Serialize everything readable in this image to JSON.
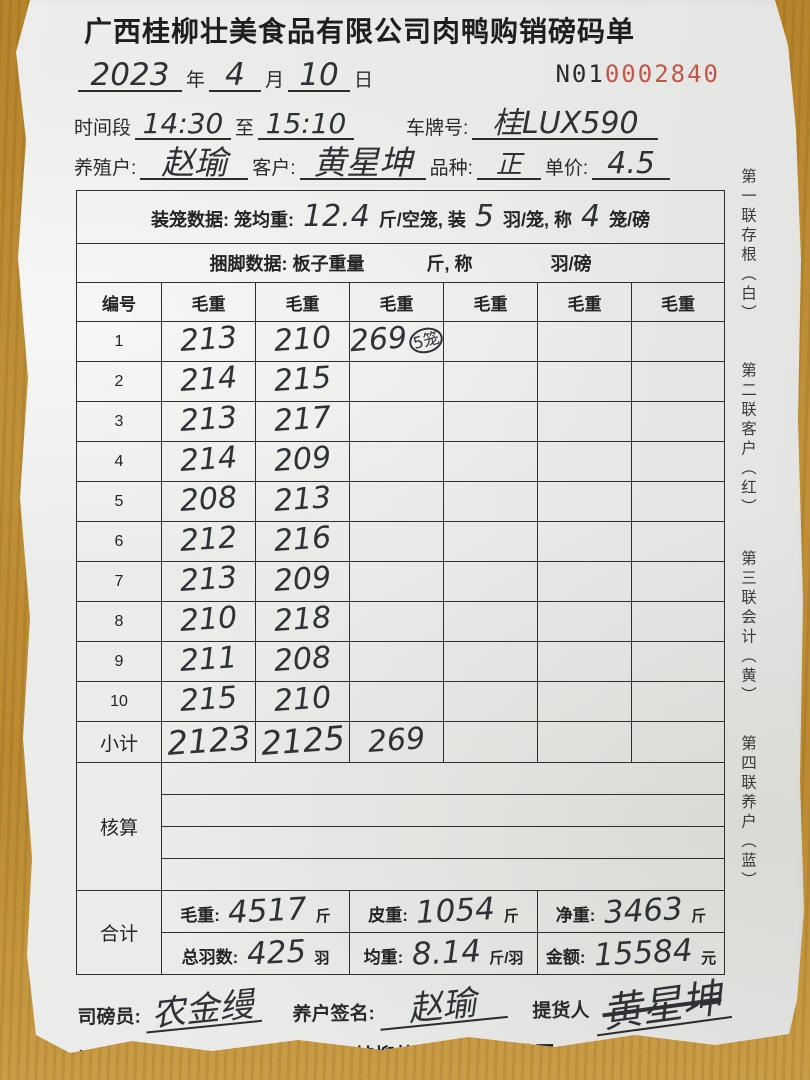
{
  "page": {
    "title": "广西桂柳壮美食品有限公司肉鸭购销磅码单"
  },
  "serial": {
    "prefix": "N01",
    "number": "0002840"
  },
  "date": {
    "year": "2023",
    "year_label": "年",
    "month": "4",
    "month_label": "月",
    "day": "10",
    "day_label": "日"
  },
  "info": {
    "time_label": "时间段",
    "time_start": "14:30",
    "to_label": "至",
    "time_end": "15:10",
    "plate_label": "车牌号:",
    "plate": "桂LUX590",
    "farmer_label": "养殖户:",
    "farmer": "赵瑜",
    "customer_label": "客户:",
    "customer": "黄星坤",
    "breed_label": "品种:",
    "breed": "正",
    "price_label": "单价:",
    "price": "4.5"
  },
  "cage_row": {
    "label": "装笼数据:",
    "avg_label": "笼均重:",
    "avg": "12.4",
    "seg1": "斤/空笼, 装",
    "per_cage": "5",
    "seg2": "羽/笼, 称",
    "per_weigh": "4",
    "seg3": "笼/磅"
  },
  "tie_row": {
    "label": "捆脚数据:",
    "seg1": "板子重量",
    "seg2": "斤, 称",
    "seg3": "羽/磅"
  },
  "weights": {
    "headers": [
      "编号",
      "毛重",
      "毛重",
      "毛重",
      "毛重",
      "毛重",
      "毛重"
    ],
    "rows": [
      {
        "no": "1",
        "v": [
          "213",
          "210",
          "269",
          "",
          "",
          ""
        ],
        "note": "5笼"
      },
      {
        "no": "2",
        "v": [
          "214",
          "215",
          "",
          "",
          "",
          ""
        ]
      },
      {
        "no": "3",
        "v": [
          "213",
          "217",
          "",
          "",
          "",
          ""
        ]
      },
      {
        "no": "4",
        "v": [
          "214",
          "209",
          "",
          "",
          "",
          ""
        ]
      },
      {
        "no": "5",
        "v": [
          "208",
          "213",
          "",
          "",
          "",
          ""
        ]
      },
      {
        "no": "6",
        "v": [
          "212",
          "216",
          "",
          "",
          "",
          ""
        ]
      },
      {
        "no": "7",
        "v": [
          "213",
          "209",
          "",
          "",
          "",
          ""
        ]
      },
      {
        "no": "8",
        "v": [
          "210",
          "218",
          "",
          "",
          "",
          ""
        ]
      },
      {
        "no": "9",
        "v": [
          "211",
          "208",
          "",
          "",
          "",
          ""
        ]
      },
      {
        "no": "10",
        "v": [
          "215",
          "210",
          "",
          "",
          "",
          ""
        ]
      }
    ],
    "subtotal": {
      "label": "小计",
      "v": [
        "2123",
        "2125",
        "269",
        "",
        "",
        ""
      ]
    }
  },
  "check": {
    "label": "核算"
  },
  "totals": {
    "label": "合计",
    "gross_label": "毛重:",
    "gross": "4517",
    "gross_unit": "斤",
    "tare_label": "皮重:",
    "tare": "1054",
    "tare_unit": "斤",
    "net_label": "净重:",
    "net": "3463",
    "net_unit": "斤",
    "count_label": "总羽数:",
    "count": "425",
    "count_unit": "羽",
    "avg_label": "均重:",
    "avg": "8.14",
    "avg_unit": "斤/羽",
    "amount_label": "金额:",
    "amount": "15584",
    "amount_unit": "元"
  },
  "signatures": {
    "weigher_label": "司磅员:",
    "weigher": "农金缦",
    "farmer_sign_label": "养户签名:",
    "farmer_sign": "赵瑜",
    "picker_label": "提货人",
    "picker": "黄星坤"
  },
  "bank": {
    "remit_label": "公司汇款账号:",
    "holder_label": "户名:",
    "holder": "广西桂柳壮美食品有限公司",
    "account_label": "账 户:",
    "account": "660000014752300022",
    "branch_label": "开户行:",
    "branch": "桂林银行南宁隆安支行"
  },
  "side_labels": [
    "第一联存根（白）",
    "第二联客户（红）",
    "第三联会计（黄）",
    "第四联养户（蓝）"
  ],
  "colors": {
    "serial_red": "#c2564a",
    "ink": "#2e3236",
    "paper": "#e9eae8",
    "wood": "#b8862e"
  }
}
